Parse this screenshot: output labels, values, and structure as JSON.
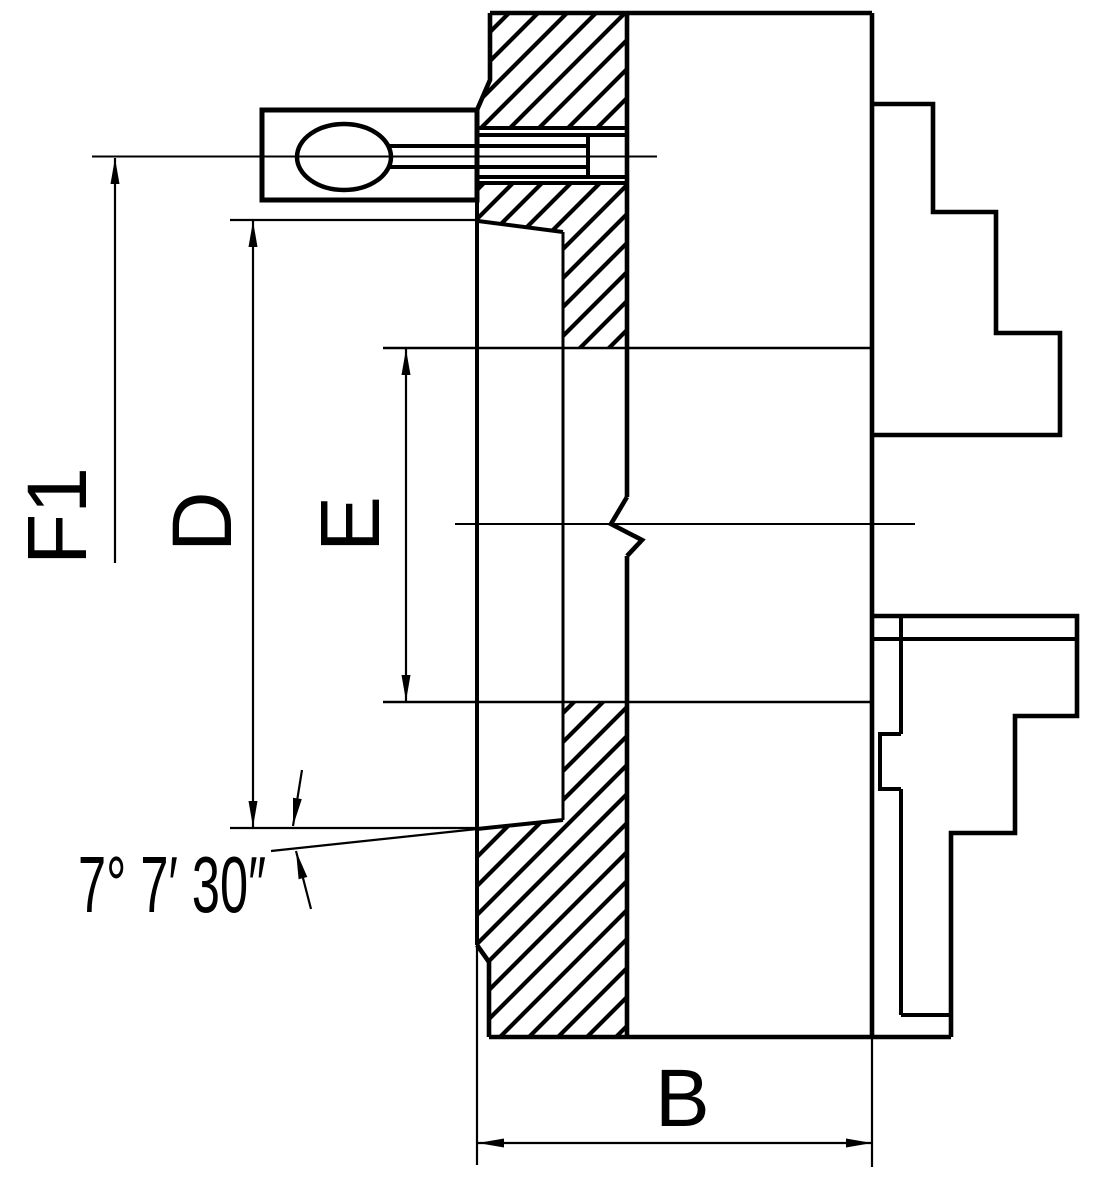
{
  "page": {
    "background": "#ffffff",
    "line_color": "#000000"
  },
  "drawing": {
    "kind": "technical-drawing",
    "subject": "lathe chuck cross-section side view with stepped jaws and key",
    "labels": {
      "f1": "F1",
      "d": "D",
      "e": "E",
      "b": "B"
    },
    "annotations": {
      "taper_angle": "7° 7′ 30″"
    }
  }
}
